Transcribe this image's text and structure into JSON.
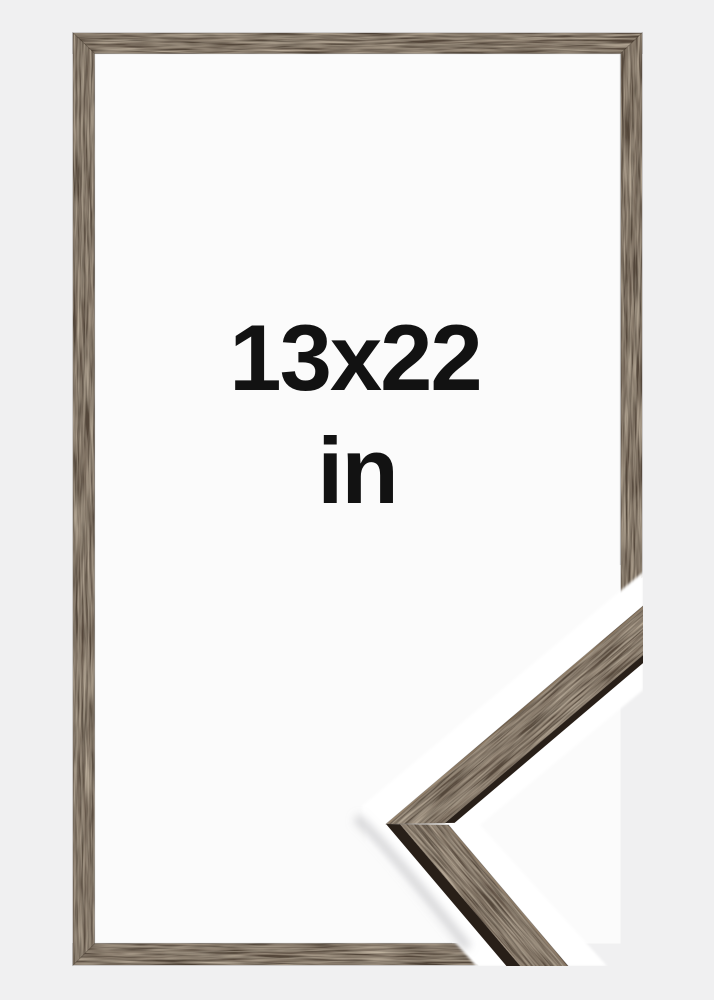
{
  "frame": {
    "size_label": "13x22",
    "unit_label": "in"
  },
  "colors": {
    "background": "#f0f0f1",
    "frame_interior": "#fbfbfb",
    "wood_bar": "#54463a",
    "wood_face": "#5c4d40",
    "wood_edge": "#281f18",
    "backdrop": "#ffffff",
    "shadow": "#a9a9ae",
    "text": "#121212"
  }
}
